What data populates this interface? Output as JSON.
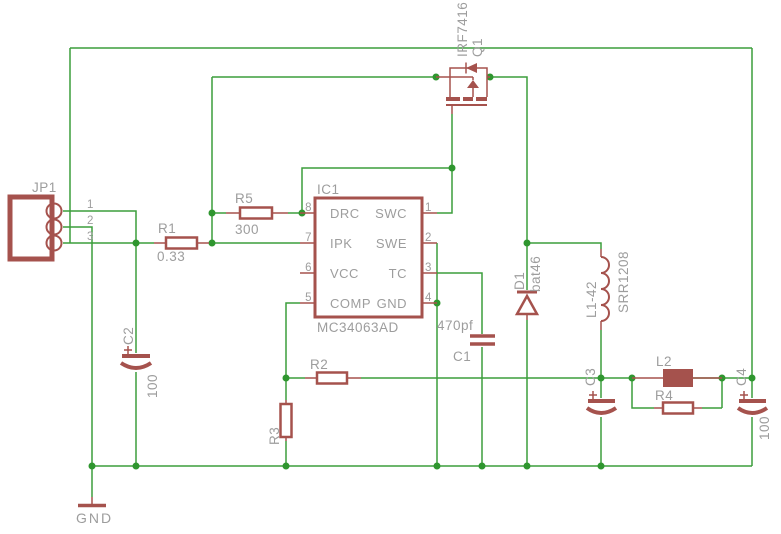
{
  "colors": {
    "background": "#ffffff",
    "wire": "#3c9e3c",
    "junction": "#2f962f",
    "component": "#a5524d",
    "label": "#9d9d9d"
  },
  "components": {
    "jp1": {
      "name": "JP1",
      "pins": [
        "1",
        "2",
        "3"
      ]
    },
    "ic1": {
      "name": "IC1",
      "value": "MC34063AD",
      "left_pins": [
        {
          "num": "8",
          "label": "DRC"
        },
        {
          "num": "7",
          "label": "IPK"
        },
        {
          "num": "6",
          "label": "VCC"
        },
        {
          "num": "5",
          "label": "COMP"
        }
      ],
      "right_pins": [
        {
          "num": "1",
          "label": "SWC"
        },
        {
          "num": "2",
          "label": "SWE"
        },
        {
          "num": "3",
          "label": "TC"
        },
        {
          "num": "4",
          "label": "GND"
        }
      ]
    },
    "q1": {
      "name": "Q1",
      "value": "IRF7416"
    },
    "r1": {
      "name": "R1",
      "value": "0.33"
    },
    "r2": {
      "name": "R2"
    },
    "r3": {
      "name": "R3"
    },
    "r4": {
      "name": "R4"
    },
    "r5": {
      "name": "R5",
      "value": "300"
    },
    "c1": {
      "name": "C1",
      "value": "470pf"
    },
    "c2": {
      "name": "C2",
      "value": "100"
    },
    "c3": {
      "name": "C3"
    },
    "c4": {
      "name": "C4",
      "value": "100"
    },
    "d1": {
      "name": "D1",
      "value": "bat46"
    },
    "l1": {
      "name": "L1-42",
      "value": "SRR1208"
    },
    "l2": {
      "name": "L2"
    },
    "gnd": {
      "label": "GND"
    }
  }
}
